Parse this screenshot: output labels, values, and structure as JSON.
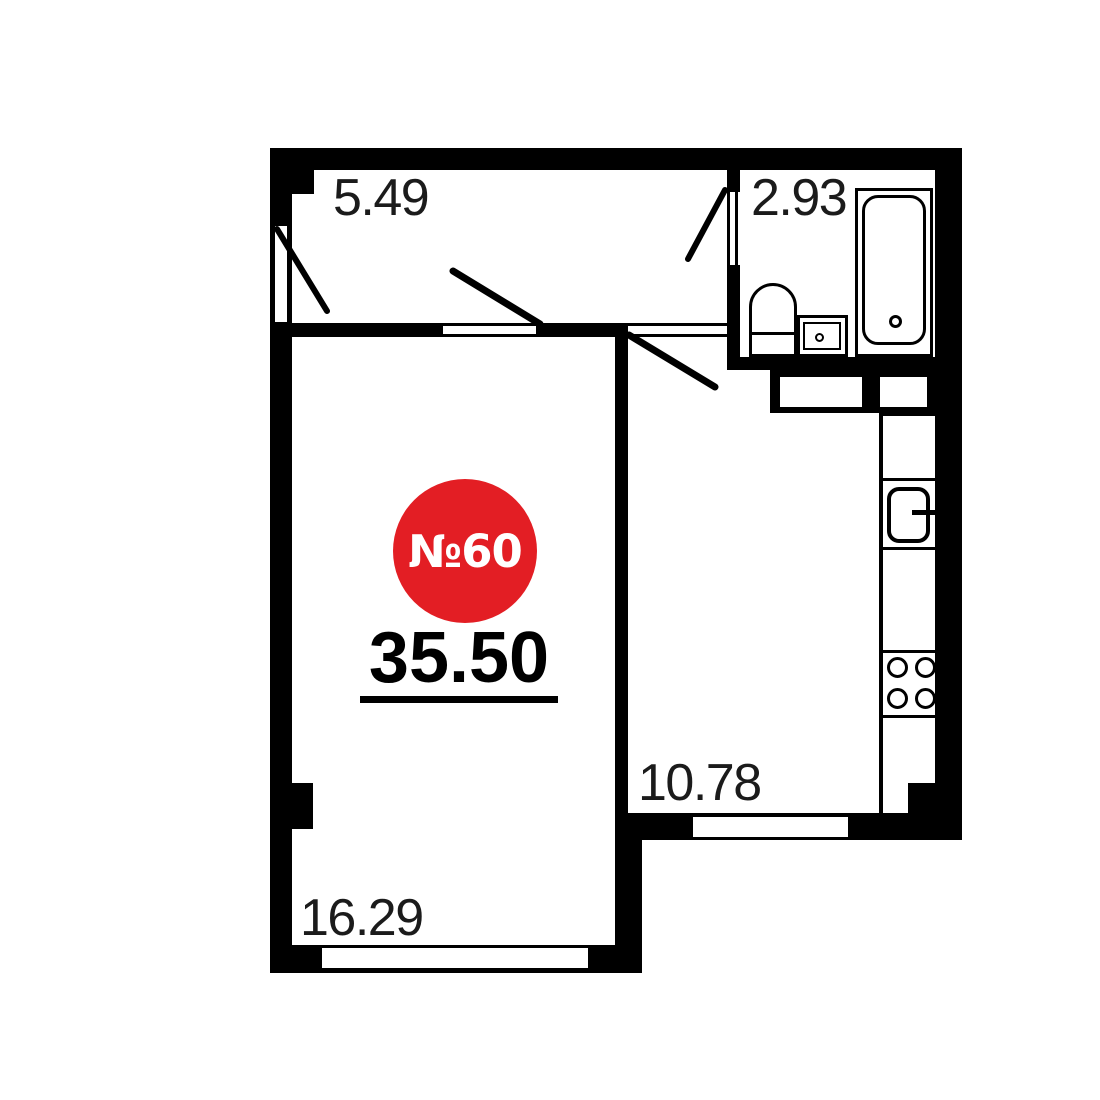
{
  "badge": {
    "unit_label": "№60",
    "area_label": "35.50",
    "color": "#e31e24"
  },
  "rooms": {
    "hallway": {
      "name": "hallway",
      "area": "5.49"
    },
    "bathroom": {
      "name": "bathroom",
      "area": "2.93"
    },
    "kitchen": {
      "name": "kitchen",
      "area": "10.78"
    },
    "living_room": {
      "name": "living-room",
      "area": "16.29"
    }
  },
  "fixtures": [
    "bathtub",
    "toilet",
    "washbasin",
    "kitchen-sink",
    "kitchen-faucet",
    "stove-4-burner",
    "kitchen-counter",
    "duct-shafts"
  ],
  "doors": [
    "entrance-door",
    "living-room-door",
    "kitchen-door",
    "bathroom-door"
  ],
  "windows": [
    "living-room-window",
    "kitchen-window"
  ],
  "colors": {
    "wall": "#000000",
    "background": "#ffffff",
    "label": "#1b1b1b"
  }
}
